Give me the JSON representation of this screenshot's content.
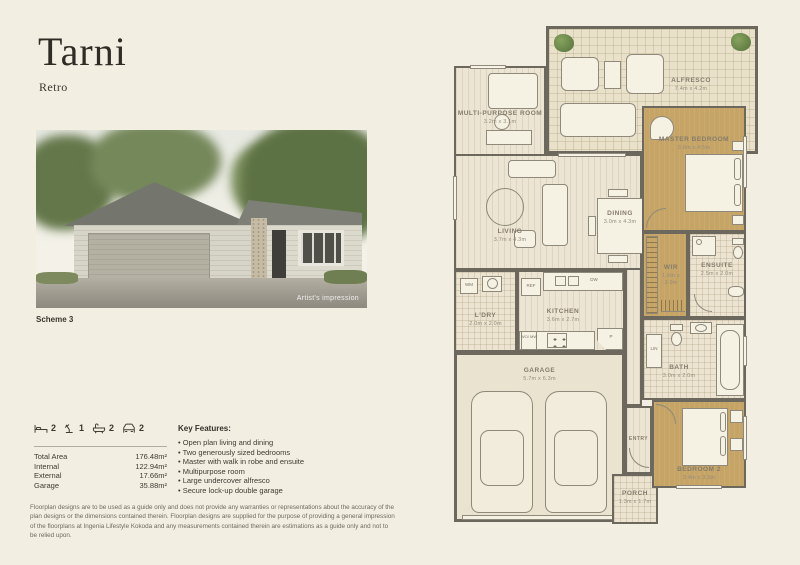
{
  "header": {
    "title": "Tarni",
    "subtitle": "Retro"
  },
  "photo": {
    "caption": "Scheme 3",
    "watermark": "Artist's impression"
  },
  "stats": {
    "icons": [
      {
        "name": "bed",
        "value": "2"
      },
      {
        "name": "study",
        "value": "1"
      },
      {
        "name": "bath",
        "value": "2"
      },
      {
        "name": "car",
        "value": "2"
      }
    ],
    "rows": [
      {
        "label": "Total Area",
        "value": "176.48m²"
      },
      {
        "label": "Internal",
        "value": "122.94m²"
      },
      {
        "label": "External",
        "value": "17.66m²"
      },
      {
        "label": "Garage",
        "value": "35.88m²"
      }
    ]
  },
  "features": {
    "heading": "Key Features:",
    "items": [
      "Open plan living and dining",
      "Two generously sized bedrooms",
      "Master with walk in robe and ensuite",
      "Multipurpose room",
      "Large undercover alfresco",
      "Secure lock-up double garage"
    ]
  },
  "disclaimer": "Floorplan designs are to be used as a guide only and does not provide any warranties or representations about the accuracy of the plan designs or the dimensions contained therein.  Floorplan designs are supplied for the purpose of providing a general impression of the floorplans at Ingenia Lifestyle Kokoda and any measurements contained therein are estimations as a guide only and not to be relied upon.",
  "floorplan": {
    "rooms": {
      "alfresco": {
        "label": "ALFRESCO",
        "dims": "7.4m x 4.2m"
      },
      "multipurpose": {
        "label": "MULTI-PURPOSE ROOM",
        "dims": "3.2m x 3.1m"
      },
      "master": {
        "label": "MASTER BEDROOM",
        "dims": "3.6m x 4.5m"
      },
      "living": {
        "label": "LIVING",
        "dims": "3.7m x 4.3m"
      },
      "dining": {
        "label": "DINING",
        "dims": "3.0m x 4.3m"
      },
      "ldry": {
        "label": "L'DRY",
        "dims": "2.0m x 2.0m"
      },
      "kitchen": {
        "label": "KITCHEN",
        "dims": "3.6m x 2.7m"
      },
      "wir": {
        "label": "WIR",
        "dims": "1.6m x 3.0m"
      },
      "ensuite": {
        "label": "ENSUITE",
        "dims": "2.5m x 2.0m"
      },
      "bath": {
        "label": "BATH",
        "dims": "3.0m x 2.0m"
      },
      "garage": {
        "label": "GARAGE",
        "dims": "5.7m x 6.3m"
      },
      "entry": {
        "label": "ENTRY"
      },
      "porch": {
        "label": "PORCH",
        "dims": "1.3m x 1.7m"
      },
      "bedroom2": {
        "label": "BEDROOM 2",
        "dims": "3.4m x 3.3m"
      }
    },
    "fixtures": {
      "wm": "WM",
      "ref": "REF",
      "dw": "DW",
      "womw": "WO/ MW",
      "p": "P",
      "lin": "LIN"
    }
  }
}
